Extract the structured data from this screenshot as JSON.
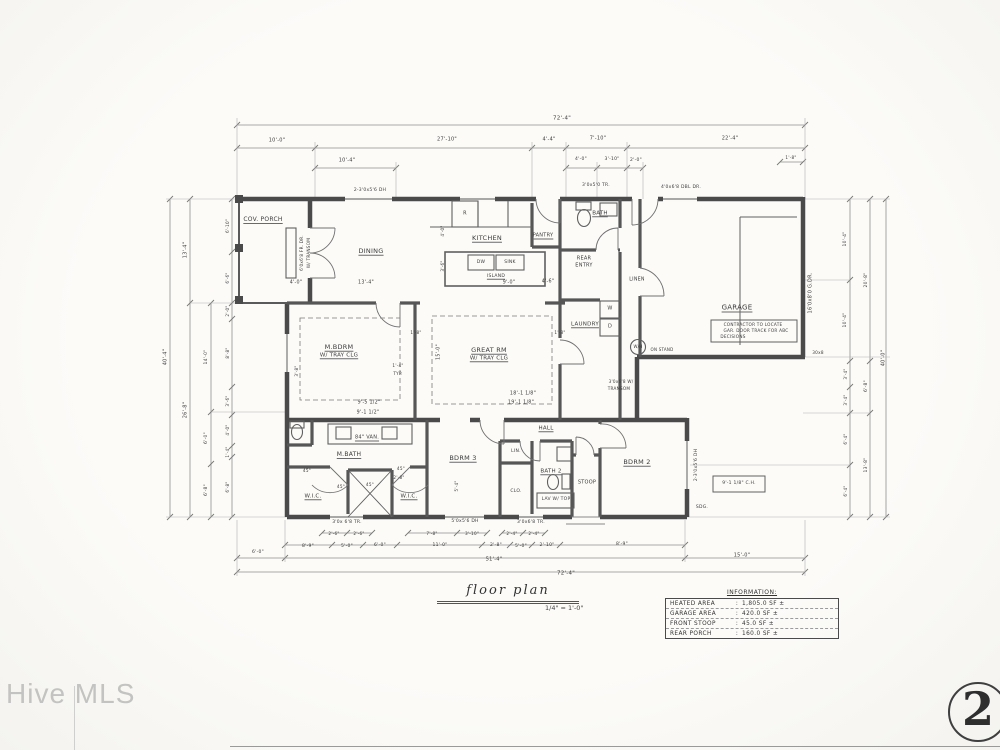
{
  "watermark": {
    "text": "Hive MLS"
  },
  "sheet": {
    "number": "2"
  },
  "title_block": {
    "title": "floor plan",
    "scale": "1/4\" = 1'-0\""
  },
  "info_table": {
    "title": "INFORMATION:",
    "separator": ":",
    "rows": [
      {
        "label": "HEATED AREA",
        "value": "1,805.0 SF ±"
      },
      {
        "label": "GARAGE AREA",
        "value": "420.0 SF ±"
      },
      {
        "label": "FRONT STOOP",
        "value": "45.0 SF ±"
      },
      {
        "label": "REAR PORCH",
        "value": "160.0 SF ±"
      }
    ]
  },
  "plan": {
    "annotations": [
      {
        "n": "room-label",
        "t": "COV. PORCH",
        "x": 263,
        "y": 220,
        "s": 6,
        "ul": 1
      },
      {
        "n": "room-label",
        "t": "DINING",
        "x": 371,
        "y": 251,
        "s": 6.5,
        "ul": 1
      },
      {
        "n": "room-label",
        "t": "KITCHEN",
        "x": 487,
        "y": 238,
        "s": 6.5,
        "ul": 1
      },
      {
        "n": "room-label",
        "t": "PANTRY",
        "x": 543,
        "y": 236,
        "s": 5,
        "ul": 1
      },
      {
        "n": "room-label",
        "t": "BATH",
        "x": 600,
        "y": 214,
        "s": 5.5,
        "ul": 1
      },
      {
        "n": "room-label",
        "t": "REAR",
        "x": 584,
        "y": 259,
        "s": 5
      },
      {
        "n": "room-label",
        "t": "ENTRY",
        "x": 584,
        "y": 266,
        "s": 5
      },
      {
        "n": "room-label",
        "t": "LAUNDRY",
        "x": 585,
        "y": 325,
        "s": 5.5,
        "ul": 1
      },
      {
        "n": "room-label",
        "t": "LINEN",
        "x": 637,
        "y": 281,
        "s": 4.8
      },
      {
        "n": "room-label",
        "t": "GARAGE",
        "x": 737,
        "y": 308,
        "s": 7,
        "ul": 1
      },
      {
        "n": "room-label",
        "t": "GREAT RM",
        "x": 489,
        "y": 350,
        "s": 6.5,
        "ul": 1
      },
      {
        "n": "room-label",
        "t": "W/ TRAY CLG",
        "x": 489,
        "y": 359,
        "s": 5.5,
        "ul": 1
      },
      {
        "n": "room-label",
        "t": "M.BDRM",
        "x": 339,
        "y": 347,
        "s": 6.5,
        "ul": 1
      },
      {
        "n": "room-label",
        "t": "W/ TRAY CLG",
        "x": 339,
        "y": 356,
        "s": 5.5,
        "ul": 1
      },
      {
        "n": "room-label",
        "t": "M.BATH",
        "x": 349,
        "y": 455,
        "s": 6,
        "ul": 1
      },
      {
        "n": "fixture-label",
        "t": "84\" VAN.",
        "x": 367,
        "y": 438,
        "s": 5,
        "ul": 1
      },
      {
        "n": "room-label",
        "t": "W.I.C.",
        "x": 313,
        "y": 497,
        "s": 5.5,
        "ul": 1
      },
      {
        "n": "room-label",
        "t": "W.I.C.",
        "x": 409,
        "y": 497,
        "s": 5.5,
        "ul": 1
      },
      {
        "n": "room-label",
        "t": "BDRM 3",
        "x": 463,
        "y": 458,
        "s": 6.5,
        "ul": 1
      },
      {
        "n": "room-label",
        "t": "HALL",
        "x": 546,
        "y": 429,
        "s": 5.5,
        "ul": 1
      },
      {
        "n": "room-label",
        "t": "BATH 2",
        "x": 551,
        "y": 472,
        "s": 5.5,
        "ul": 1
      },
      {
        "n": "fixture-label",
        "t": "LAV W/ TOP",
        "x": 556,
        "y": 500,
        "s": 4.5
      },
      {
        "n": "room-label",
        "t": "STOOP",
        "x": 587,
        "y": 483,
        "s": 5
      },
      {
        "n": "room-label",
        "t": "BDRM 2",
        "x": 637,
        "y": 462,
        "s": 6.5,
        "ul": 1
      },
      {
        "n": "fixture-label",
        "t": "W",
        "x": 610,
        "y": 309,
        "s": 5
      },
      {
        "n": "fixture-label",
        "t": "D",
        "x": 610,
        "y": 327,
        "s": 5
      },
      {
        "n": "fixture-label",
        "t": "W/H",
        "x": 638,
        "y": 347,
        "s": 4
      },
      {
        "n": "note-text",
        "t": "ON STAND",
        "x": 662,
        "y": 350,
        "s": 4
      },
      {
        "n": "fixture-label",
        "t": "R",
        "x": 465,
        "y": 214,
        "s": 5
      },
      {
        "n": "fixture-label",
        "t": "DW",
        "x": 481,
        "y": 263,
        "s": 4.5
      },
      {
        "n": "fixture-label",
        "t": "SINK",
        "x": 510,
        "y": 263,
        "s": 4.5
      },
      {
        "n": "fixture-label",
        "t": "ISLAND",
        "x": 496,
        "y": 277,
        "s": 4.5,
        "ul": 1
      },
      {
        "n": "room-label",
        "t": "LIN.",
        "x": 516,
        "y": 452,
        "s": 4.5
      },
      {
        "n": "room-label",
        "t": "CLO.",
        "x": 516,
        "y": 492,
        "s": 4.5
      },
      {
        "n": "note-text",
        "t": "CONTRACTOR TO LOCATE",
        "x": 753,
        "y": 325,
        "s": 4.2
      },
      {
        "n": "note-text",
        "t": "GAR. DOOR TRACK FOR ABC",
        "x": 756,
        "y": 331,
        "s": 4.2
      },
      {
        "n": "note-text",
        "t": "DECISIONS",
        "x": 733,
        "y": 337,
        "s": 4.2
      },
      {
        "n": "note-text",
        "t": "9'-1 1/8\" C.H.",
        "x": 739,
        "y": 484,
        "s": 4.5
      },
      {
        "n": "note-text",
        "t": "SDG.",
        "x": 702,
        "y": 508,
        "s": 4.5
      },
      {
        "n": "note-text",
        "t": "30x8",
        "x": 818,
        "y": 353,
        "s": 4.2
      },
      {
        "n": "window-label",
        "t": "2-3'0x5'6 DH",
        "x": 370,
        "y": 191,
        "s": 4.5
      },
      {
        "n": "window-label",
        "t": "3'0x5'0 TR.",
        "x": 596,
        "y": 186,
        "s": 4.5
      },
      {
        "n": "window-label",
        "t": "4'0x6'8 DBL DR.",
        "x": 681,
        "y": 188,
        "s": 4.5
      },
      {
        "n": "window-label",
        "t": "6'0x6'8 FR. DR.",
        "x": 302,
        "y": 253,
        "s": 4.2,
        "r": -90
      },
      {
        "n": "window-label",
        "t": "W/ TRANSOM",
        "x": 309,
        "y": 253,
        "s": 4.2,
        "r": -90
      },
      {
        "n": "window-label",
        "t": "16'0x8'0 G.DR.",
        "x": 811,
        "y": 293,
        "s": 5,
        "r": -90
      },
      {
        "n": "window-label",
        "t": "2-3'0x5'6 DH",
        "x": 697,
        "y": 465,
        "s": 4.5,
        "r": -90
      },
      {
        "n": "window-label",
        "t": "3'0x 6'8 TR.",
        "x": 347,
        "y": 523,
        "s": 4.5
      },
      {
        "n": "window-label",
        "t": "5'0x5'6 DH",
        "x": 465,
        "y": 522,
        "s": 4.5
      },
      {
        "n": "window-label",
        "t": "3'0x6'8 TR.",
        "x": 531,
        "y": 523,
        "s": 4.5
      },
      {
        "n": "window-label",
        "t": "3'0x6'8 W/",
        "x": 621,
        "y": 382,
        "s": 4.2
      },
      {
        "n": "window-label",
        "t": "TRANSOM",
        "x": 619,
        "y": 389,
        "s": 4.2
      },
      {
        "n": "dim-text",
        "t": "13'-4\"",
        "x": 366,
        "y": 284,
        "s": 4.8
      },
      {
        "n": "dim-text",
        "t": "4'-0\"",
        "x": 296,
        "y": 284,
        "s": 4.8
      },
      {
        "n": "dim-text",
        "t": "9'-0\"",
        "x": 509,
        "y": 284,
        "s": 4.8
      },
      {
        "n": "dim-text",
        "t": "4'-6\"",
        "x": 548,
        "y": 283,
        "s": 4.8
      },
      {
        "n": "dim-text",
        "t": "18'-1 1/8\"",
        "x": 523,
        "y": 395,
        "s": 4.8
      },
      {
        "n": "dim-text",
        "t": "19'-1 1/8\"",
        "x": 521,
        "y": 404,
        "s": 4.8
      },
      {
        "n": "dim-text",
        "t": "15'-0\"",
        "x": 440,
        "y": 352,
        "s": 4.8,
        "r": -90
      },
      {
        "n": "dim-text",
        "t": "9'-5 1/2\"",
        "x": 369,
        "y": 404,
        "s": 4.8
      },
      {
        "n": "dim-text",
        "t": "9'-1 1/2\"",
        "x": 368,
        "y": 414,
        "s": 4.8
      },
      {
        "n": "dim-text",
        "t": "1'-8\"",
        "x": 560,
        "y": 333,
        "s": 4.2
      },
      {
        "n": "dim-text",
        "t": "1'-4\"",
        "x": 398,
        "y": 366,
        "s": 4.2
      },
      {
        "n": "dim-text",
        "t": "TYP.",
        "x": 398,
        "y": 374,
        "s": 4.2
      },
      {
        "n": "dim-text",
        "t": "45°",
        "x": 307,
        "y": 471,
        "s": 4.2
      },
      {
        "n": "dim-text",
        "t": "45°",
        "x": 341,
        "y": 487,
        "s": 4.2
      },
      {
        "n": "dim-text",
        "t": "45°",
        "x": 370,
        "y": 485,
        "s": 4.2
      },
      {
        "n": "dim-text",
        "t": "45°",
        "x": 401,
        "y": 469,
        "s": 4.2
      },
      {
        "n": "dim-text",
        "t": "3'-8\"",
        "x": 297,
        "y": 371,
        "s": 4.2,
        "r": -90
      },
      {
        "n": "dim-text",
        "t": "4'-0\"",
        "x": 443,
        "y": 231,
        "s": 4.2,
        "r": -90
      },
      {
        "n": "dim-text",
        "t": "3'-6\"",
        "x": 443,
        "y": 266,
        "s": 4.2,
        "r": -90
      },
      {
        "n": "dim-text",
        "t": "5'-4\"",
        "x": 457,
        "y": 486,
        "s": 4.2,
        "r": -90
      },
      {
        "n": "dim-text",
        "t": "2'-8\"",
        "x": 399,
        "y": 478,
        "s": 4.2
      },
      {
        "n": "dim-text",
        "t": "1'-8\"",
        "x": 416,
        "y": 333,
        "s": 4.2
      },
      {
        "n": "dim-text",
        "t": "72'-4\"",
        "x": 562,
        "y": 119,
        "s": 5.5
      },
      {
        "n": "dim-text",
        "t": "10'-0\"",
        "x": 277,
        "y": 141,
        "s": 5
      },
      {
        "n": "dim-text",
        "t": "27'-10\"",
        "x": 447,
        "y": 140,
        "s": 5
      },
      {
        "n": "dim-text",
        "t": "4'-4\"",
        "x": 549,
        "y": 140,
        "s": 5
      },
      {
        "n": "dim-text",
        "t": "7'-10\"",
        "x": 598,
        "y": 139,
        "s": 5
      },
      {
        "n": "dim-text",
        "t": "22'-4\"",
        "x": 730,
        "y": 139,
        "s": 5
      },
      {
        "n": "dim-text",
        "t": "10'-4\"",
        "x": 347,
        "y": 161,
        "s": 5
      },
      {
        "n": "dim-text",
        "t": "4'-0\"",
        "x": 581,
        "y": 160,
        "s": 4.5
      },
      {
        "n": "dim-text",
        "t": "3'-10\"",
        "x": 612,
        "y": 160,
        "s": 4.5
      },
      {
        "n": "dim-text",
        "t": "2'-0\"",
        "x": 636,
        "y": 161,
        "s": 4.5
      },
      {
        "n": "dim-text",
        "t": "1'-8\"",
        "x": 791,
        "y": 158,
        "s": 4.2
      },
      {
        "n": "dim-text",
        "t": "72'-4\"",
        "x": 566,
        "y": 574,
        "s": 5.5
      },
      {
        "n": "dim-text",
        "t": "51'-4\"",
        "x": 494,
        "y": 560,
        "s": 5
      },
      {
        "n": "dim-text",
        "t": "15'-0\"",
        "x": 742,
        "y": 556,
        "s": 5
      },
      {
        "n": "dim-text",
        "t": "6'-0\"",
        "x": 258,
        "y": 553,
        "s": 4.5
      },
      {
        "n": "dim-text",
        "t": "8'-9\"",
        "x": 308,
        "y": 547,
        "s": 4.5
      },
      {
        "n": "dim-text",
        "t": "5'-0\"",
        "x": 347,
        "y": 547,
        "s": 4.5
      },
      {
        "n": "dim-text",
        "t": "6'-0\"",
        "x": 380,
        "y": 546,
        "s": 4.5
      },
      {
        "n": "dim-text",
        "t": "11'-0\"",
        "x": 440,
        "y": 546,
        "s": 4.5
      },
      {
        "n": "dim-text",
        "t": "2'-8\"",
        "x": 496,
        "y": 546,
        "s": 4.5
      },
      {
        "n": "dim-text",
        "t": "5'-0\"",
        "x": 521,
        "y": 547,
        "s": 4.5
      },
      {
        "n": "dim-text",
        "t": "2'-10\"",
        "x": 547,
        "y": 546,
        "s": 4.5
      },
      {
        "n": "dim-text",
        "t": "8'-9\"",
        "x": 622,
        "y": 545,
        "s": 4.5
      },
      {
        "n": "dim-text",
        "t": "7'-8\"",
        "x": 432,
        "y": 534,
        "s": 4.2
      },
      {
        "n": "dim-text",
        "t": "3'-10\"",
        "x": 472,
        "y": 534,
        "s": 4.2
      },
      {
        "n": "dim-text",
        "t": "2'-6\"",
        "x": 334,
        "y": 534,
        "s": 4.2
      },
      {
        "n": "dim-text",
        "t": "2'-6\"",
        "x": 359,
        "y": 534,
        "s": 4.2
      },
      {
        "n": "dim-text",
        "t": "2'-4\"",
        "x": 512,
        "y": 534,
        "s": 4.2
      },
      {
        "n": "dim-text",
        "t": "2'-4\"",
        "x": 534,
        "y": 534,
        "s": 4.2
      },
      {
        "n": "dim-text",
        "t": "40'-4\"",
        "x": 166,
        "y": 357,
        "s": 5,
        "r": -90
      },
      {
        "n": "dim-text",
        "t": "13'-4\"",
        "x": 186,
        "y": 250,
        "s": 5,
        "r": -90
      },
      {
        "n": "dim-text",
        "t": "26'-8\"",
        "x": 186,
        "y": 410,
        "s": 5,
        "r": -90
      },
      {
        "n": "dim-text",
        "t": "14'-0\"",
        "x": 207,
        "y": 357,
        "s": 4.5,
        "r": -90
      },
      {
        "n": "dim-text",
        "t": "6'-0\"",
        "x": 207,
        "y": 438,
        "s": 4.5,
        "r": -90
      },
      {
        "n": "dim-text",
        "t": "6'-8\"",
        "x": 207,
        "y": 490,
        "s": 4.5,
        "r": -90
      },
      {
        "n": "dim-text",
        "t": "6'-10\"",
        "x": 228,
        "y": 226,
        "s": 4.2,
        "r": -90
      },
      {
        "n": "dim-text",
        "t": "6'-6\"",
        "x": 228,
        "y": 278,
        "s": 4.2,
        "r": -90
      },
      {
        "n": "dim-text",
        "t": "2'-0\"",
        "x": 228,
        "y": 311,
        "s": 4.2,
        "r": -90
      },
      {
        "n": "dim-text",
        "t": "8'-8\"",
        "x": 228,
        "y": 353,
        "s": 4.2,
        "r": -90
      },
      {
        "n": "dim-text",
        "t": "3'-6\"",
        "x": 228,
        "y": 401,
        "s": 4.2,
        "r": -90
      },
      {
        "n": "dim-text",
        "t": "4'-0\"",
        "x": 228,
        "y": 430,
        "s": 4.2,
        "r": -90
      },
      {
        "n": "dim-text",
        "t": "1'-4\"",
        "x": 228,
        "y": 452,
        "s": 4.2,
        "r": -90
      },
      {
        "n": "dim-text",
        "t": "6'-8\"",
        "x": 228,
        "y": 487,
        "s": 4.2,
        "r": -90
      },
      {
        "n": "dim-text",
        "t": "10'-4\"",
        "x": 846,
        "y": 239,
        "s": 4.5,
        "r": -90
      },
      {
        "n": "dim-text",
        "t": "10'-4\"",
        "x": 846,
        "y": 320,
        "s": 4.5,
        "r": -90
      },
      {
        "n": "dim-text",
        "t": "3'-4\"",
        "x": 846,
        "y": 374,
        "s": 4.2,
        "r": -90
      },
      {
        "n": "dim-text",
        "t": "3'-4\"",
        "x": 846,
        "y": 400,
        "s": 4.2,
        "r": -90
      },
      {
        "n": "dim-text",
        "t": "6'-4\"",
        "x": 846,
        "y": 439,
        "s": 4.2,
        "r": -90
      },
      {
        "n": "dim-text",
        "t": "6'-4\"",
        "x": 846,
        "y": 491,
        "s": 4.2,
        "r": -90
      },
      {
        "n": "dim-text",
        "t": "20'-8\"",
        "x": 867,
        "y": 280,
        "s": 4.5,
        "r": -90
      },
      {
        "n": "dim-text",
        "t": "6'-8\"",
        "x": 867,
        "y": 386,
        "s": 4.5,
        "r": -90
      },
      {
        "n": "dim-text",
        "t": "13'-8\"",
        "x": 867,
        "y": 465,
        "s": 4.5,
        "r": -90
      },
      {
        "n": "dim-text",
        "t": "40'-0\"",
        "x": 884,
        "y": 358,
        "s": 5,
        "r": -90
      }
    ]
  }
}
